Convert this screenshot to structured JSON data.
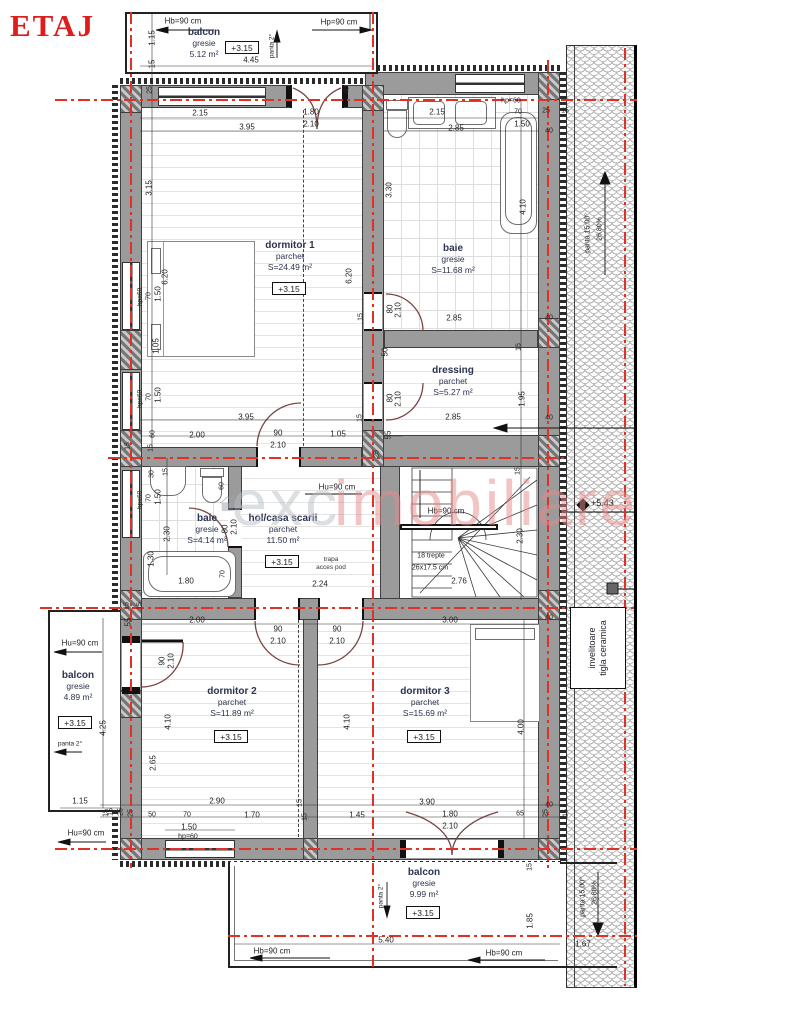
{
  "title": "ETAJ",
  "watermark": {
    "brand_gray": "exc",
    "brand_accent": "imobiliare"
  },
  "rooms": [
    {
      "id": "balcon-top",
      "name": "balcon",
      "finish": "gresie",
      "area": "5.12 m²",
      "level": "+3.15"
    },
    {
      "id": "dormitor-1",
      "name": "dormitor 1",
      "finish": "parchet",
      "area": "S=24.49 m²",
      "level": "+3.15"
    },
    {
      "id": "baie-mare",
      "name": "baie",
      "finish": "gresie",
      "area": "S=11.68 m²"
    },
    {
      "id": "dressing",
      "name": "dressing",
      "finish": "parchet",
      "area": "S=5.27 m²"
    },
    {
      "id": "baie-mica",
      "name": "baie",
      "finish": "gresie",
      "area": "S=4.14 m²"
    },
    {
      "id": "hol",
      "name": "hol/casa scarii",
      "finish": "parchet",
      "area": "11.50 m²",
      "level": "+3.15",
      "note1": "trapa",
      "note2": "acces pod"
    },
    {
      "id": "dormitor-2",
      "name": "dormitor 2",
      "finish": "parchet",
      "area": "S=11.89 m²",
      "level": "+3.15"
    },
    {
      "id": "dormitor-3",
      "name": "dormitor 3",
      "finish": "parchet",
      "area": "S=15.69 m²",
      "level": "+3.15"
    },
    {
      "id": "balcon-stanga",
      "name": "balcon",
      "finish": "gresie",
      "area": "4.89 m²",
      "level": "+3.15"
    },
    {
      "id": "balcon-jos",
      "name": "balcon",
      "finish": "gresie",
      "area": "9.99 m²",
      "level": "+3.15"
    }
  ],
  "roof": {
    "covering_line1": "invelitoare",
    "covering_line2": "tigla ceramica",
    "pitch": "panta 15.00°",
    "pitch_percent": "26.80%",
    "ridge_level": "+5.43"
  },
  "dims": [
    {
      "t": "Hb=90 cm",
      "x": 183,
      "y": 21
    },
    {
      "t": "Hp=90 cm",
      "x": 339,
      "y": 22
    },
    {
      "t": "1.15",
      "x": 152,
      "y": 38,
      "r": -90
    },
    {
      "t": "15",
      "x": 152,
      "y": 64,
      "r": -90
    },
    {
      "t": "4.45",
      "x": 251,
      "y": 60
    },
    {
      "t": "panta 2°",
      "x": 272,
      "y": 46,
      "r": -90,
      "s": 6.5
    },
    {
      "t": "25",
      "x": 150,
      "y": 90,
      "r": -90,
      "s": 7
    },
    {
      "t": "40",
      "x": 347,
      "y": 90,
      "r": -90,
      "s": 7
    },
    {
      "t": "2.15",
      "x": 200,
      "y": 113
    },
    {
      "t": "1.80",
      "x": 311,
      "y": 112
    },
    {
      "t": "2.10",
      "x": 311,
      "y": 124
    },
    {
      "t": "3.95",
      "x": 247,
      "y": 127
    },
    {
      "t": "hp=60",
      "x": 511,
      "y": 101,
      "s": 7
    },
    {
      "t": "2.15",
      "x": 437,
      "y": 112
    },
    {
      "t": "70",
      "x": 518,
      "y": 112,
      "s": 7
    },
    {
      "t": "1.50",
      "x": 522,
      "y": 124
    },
    {
      "t": "25",
      "x": 546,
      "y": 111,
      "s": 7
    },
    {
      "t": "15",
      "x": 565,
      "y": 111,
      "s": 7
    },
    {
      "t": "2.85",
      "x": 456,
      "y": 128
    },
    {
      "t": "40",
      "x": 549,
      "y": 131,
      "s": 7
    },
    {
      "t": "3.30",
      "x": 389,
      "y": 190,
      "r": -90
    },
    {
      "t": "4.10",
      "x": 523,
      "y": 207,
      "r": -90
    },
    {
      "t": "3.15",
      "x": 149,
      "y": 188,
      "r": -90
    },
    {
      "t": "6.20",
      "x": 165,
      "y": 277,
      "r": -90
    },
    {
      "t": "hp=60",
      "x": 140,
      "y": 297,
      "r": -90,
      "s": 6.5
    },
    {
      "t": "70",
      "x": 149,
      "y": 296,
      "r": -90,
      "s": 7
    },
    {
      "t": "1.50",
      "x": 158,
      "y": 294,
      "r": -90
    },
    {
      "t": "1.05",
      "x": 156,
      "y": 346,
      "r": -90
    },
    {
      "t": "hp=60",
      "x": 140,
      "y": 399,
      "r": -90,
      "s": 6.5
    },
    {
      "t": "70",
      "x": 149,
      "y": 397,
      "r": -90,
      "s": 7
    },
    {
      "t": "1.50",
      "x": 158,
      "y": 395,
      "r": -90
    },
    {
      "t": "6.20",
      "x": 349,
      "y": 276,
      "r": -90
    },
    {
      "t": "15",
      "x": 361,
      "y": 317,
      "r": -90,
      "s": 7
    },
    {
      "t": "80",
      "x": 390,
      "y": 309,
      "r": -90
    },
    {
      "t": "2.10",
      "x": 398,
      "y": 310,
      "r": -90
    },
    {
      "t": "2.85",
      "x": 454,
      "y": 318
    },
    {
      "t": "40",
      "x": 549,
      "y": 318,
      "s": 7
    },
    {
      "t": "15",
      "x": 519,
      "y": 347,
      "r": -90,
      "s": 7
    },
    {
      "t": "50",
      "x": 385,
      "y": 352,
      "r": -90
    },
    {
      "t": "80",
      "x": 390,
      "y": 398,
      "r": -90
    },
    {
      "t": "2.10",
      "x": 398,
      "y": 399,
      "r": -90
    },
    {
      "t": "1.95",
      "x": 522,
      "y": 399,
      "r": -90
    },
    {
      "t": "2.85",
      "x": 453,
      "y": 417
    },
    {
      "t": "40",
      "x": 549,
      "y": 418,
      "s": 7
    },
    {
      "t": "15",
      "x": 360,
      "y": 418,
      "r": -90,
      "s": 7
    },
    {
      "t": "55",
      "x": 388,
      "y": 435,
      "r": -90
    },
    {
      "t": "25",
      "x": 377,
      "y": 454,
      "r": -90,
      "s": 7
    },
    {
      "t": "3.95",
      "x": 246,
      "y": 417
    },
    {
      "t": "60",
      "x": 153,
      "y": 434,
      "r": -90,
      "s": 7
    },
    {
      "t": "2.00",
      "x": 197,
      "y": 435
    },
    {
      "t": "90",
      "x": 278,
      "y": 433
    },
    {
      "t": "2.10",
      "x": 278,
      "y": 445
    },
    {
      "t": "1.05",
      "x": 338,
      "y": 434
    },
    {
      "t": "15",
      "x": 151,
      "y": 448,
      "r": -90,
      "s": 7
    },
    {
      "t": "15",
      "x": 128,
      "y": 446,
      "r": -90,
      "s": 7
    },
    {
      "t": "30",
      "x": 152,
      "y": 474,
      "r": -90,
      "s": 7
    },
    {
      "t": "15",
      "x": 166,
      "y": 472,
      "r": -90,
      "s": 7
    },
    {
      "t": "hp=60",
      "x": 140,
      "y": 500,
      "r": -90,
      "s": 6.5
    },
    {
      "t": "70",
      "x": 149,
      "y": 498,
      "r": -90,
      "s": 7
    },
    {
      "t": "1.50",
      "x": 158,
      "y": 497,
      "r": -90
    },
    {
      "t": "2.30",
      "x": 167,
      "y": 534,
      "r": -90
    },
    {
      "t": "1.30",
      "x": 151,
      "y": 559,
      "r": -90
    },
    {
      "t": "60",
      "x": 222,
      "y": 486,
      "r": -90,
      "s": 7
    },
    {
      "t": "80",
      "x": 225,
      "y": 529,
      "r": -90
    },
    {
      "t": "2.10",
      "x": 234,
      "y": 527,
      "r": -90
    },
    {
      "t": "1.80",
      "x": 186,
      "y": 581
    },
    {
      "t": "70",
      "x": 223,
      "y": 574,
      "r": -90,
      "s": 7
    },
    {
      "t": "15",
      "x": 127,
      "y": 606,
      "r": -90,
      "s": 7
    },
    {
      "t": "15",
      "x": 140,
      "y": 606,
      "r": -90,
      "s": 7
    },
    {
      "t": "55",
      "x": 128,
      "y": 622,
      "r": -90
    },
    {
      "t": "Hu=90 cm",
      "x": 337,
      "y": 487
    },
    {
      "t": "2.24",
      "x": 320,
      "y": 584
    },
    {
      "t": "15",
      "x": 518,
      "y": 471,
      "r": -90,
      "s": 7
    },
    {
      "t": "Hb=90 cm",
      "x": 446,
      "y": 511
    },
    {
      "t": "2.30",
      "x": 520,
      "y": 536,
      "r": -90
    },
    {
      "t": "18 trepte",
      "x": 431,
      "y": 556,
      "s": 7
    },
    {
      "t": "26x17.5 cm",
      "x": 430,
      "y": 568,
      "s": 7
    },
    {
      "t": "2.76",
      "x": 459,
      "y": 581
    },
    {
      "t": "40",
      "x": 549,
      "y": 618,
      "s": 7
    },
    {
      "t": "Hu=90 cm",
      "x": 80,
      "y": 643
    },
    {
      "t": "4.25",
      "x": 103,
      "y": 728,
      "r": -90
    },
    {
      "t": "panta 2°",
      "x": 70,
      "y": 744,
      "s": 6.5
    },
    {
      "t": "1.15",
      "x": 80,
      "y": 801
    },
    {
      "t": "Hu=90 cm",
      "x": 86,
      "y": 833
    },
    {
      "t": "15",
      "x": 111,
      "y": 812,
      "r": -90,
      "s": 7
    },
    {
      "t": "25",
      "x": 121,
      "y": 812,
      "r": -90,
      "s": 7
    },
    {
      "t": "2.00",
      "x": 197,
      "y": 620
    },
    {
      "t": "90",
      "x": 162,
      "y": 661,
      "r": -90
    },
    {
      "t": "2.10",
      "x": 171,
      "y": 661,
      "r": -90
    },
    {
      "t": "90",
      "x": 278,
      "y": 629
    },
    {
      "t": "2.10",
      "x": 278,
      "y": 641
    },
    {
      "t": "90",
      "x": 337,
      "y": 629
    },
    {
      "t": "2.10",
      "x": 337,
      "y": 641
    },
    {
      "t": "3.00",
      "x": 450,
      "y": 620
    },
    {
      "t": "4.10",
      "x": 168,
      "y": 722,
      "r": -90
    },
    {
      "t": "2.65",
      "x": 153,
      "y": 763,
      "r": -90
    },
    {
      "t": "4.10",
      "x": 347,
      "y": 722,
      "r": -90
    },
    {
      "t": "4.00",
      "x": 521,
      "y": 727,
      "r": -90
    },
    {
      "t": "2.90",
      "x": 217,
      "y": 801
    },
    {
      "t": "15",
      "x": 300,
      "y": 803,
      "r": -90,
      "s": 7
    },
    {
      "t": "3.90",
      "x": 427,
      "y": 802
    },
    {
      "t": "15",
      "x": 106,
      "y": 813,
      "r": -90,
      "s": 7
    },
    {
      "t": "25",
      "x": 131,
      "y": 813,
      "r": -90,
      "s": 7
    },
    {
      "t": "50",
      "x": 152,
      "y": 815,
      "s": 7
    },
    {
      "t": "70",
      "x": 187,
      "y": 815,
      "s": 7
    },
    {
      "t": "1.50",
      "x": 189,
      "y": 827
    },
    {
      "t": "1.70",
      "x": 252,
      "y": 815
    },
    {
      "t": "15",
      "x": 305,
      "y": 817,
      "r": -90,
      "s": 7
    },
    {
      "t": "1.45",
      "x": 357,
      "y": 815
    },
    {
      "t": "1.80",
      "x": 450,
      "y": 814
    },
    {
      "t": "2.10",
      "x": 450,
      "y": 826
    },
    {
      "t": "65",
      "x": 520,
      "y": 814,
      "s": 7
    },
    {
      "t": "25",
      "x": 546,
      "y": 813,
      "r": -90,
      "s": 7
    },
    {
      "t": "15",
      "x": 566,
      "y": 813,
      "r": -90,
      "s": 7
    },
    {
      "t": "40",
      "x": 549,
      "y": 805,
      "s": 7
    },
    {
      "t": "hp=60",
      "x": 188,
      "y": 837,
      "s": 7
    },
    {
      "t": "15",
      "x": 530,
      "y": 867,
      "r": -90,
      "s": 7
    },
    {
      "t": "1.85",
      "x": 530,
      "y": 921,
      "r": -90
    },
    {
      "t": "panta 2°",
      "x": 381,
      "y": 896,
      "r": -90,
      "s": 6.5
    },
    {
      "t": "5.40",
      "x": 386,
      "y": 940
    },
    {
      "t": "Hb=90 cm",
      "x": 272,
      "y": 951
    },
    {
      "t": "Hb=90 cm",
      "x": 504,
      "y": 953
    },
    {
      "t": "1.67",
      "x": 583,
      "y": 944
    }
  ]
}
